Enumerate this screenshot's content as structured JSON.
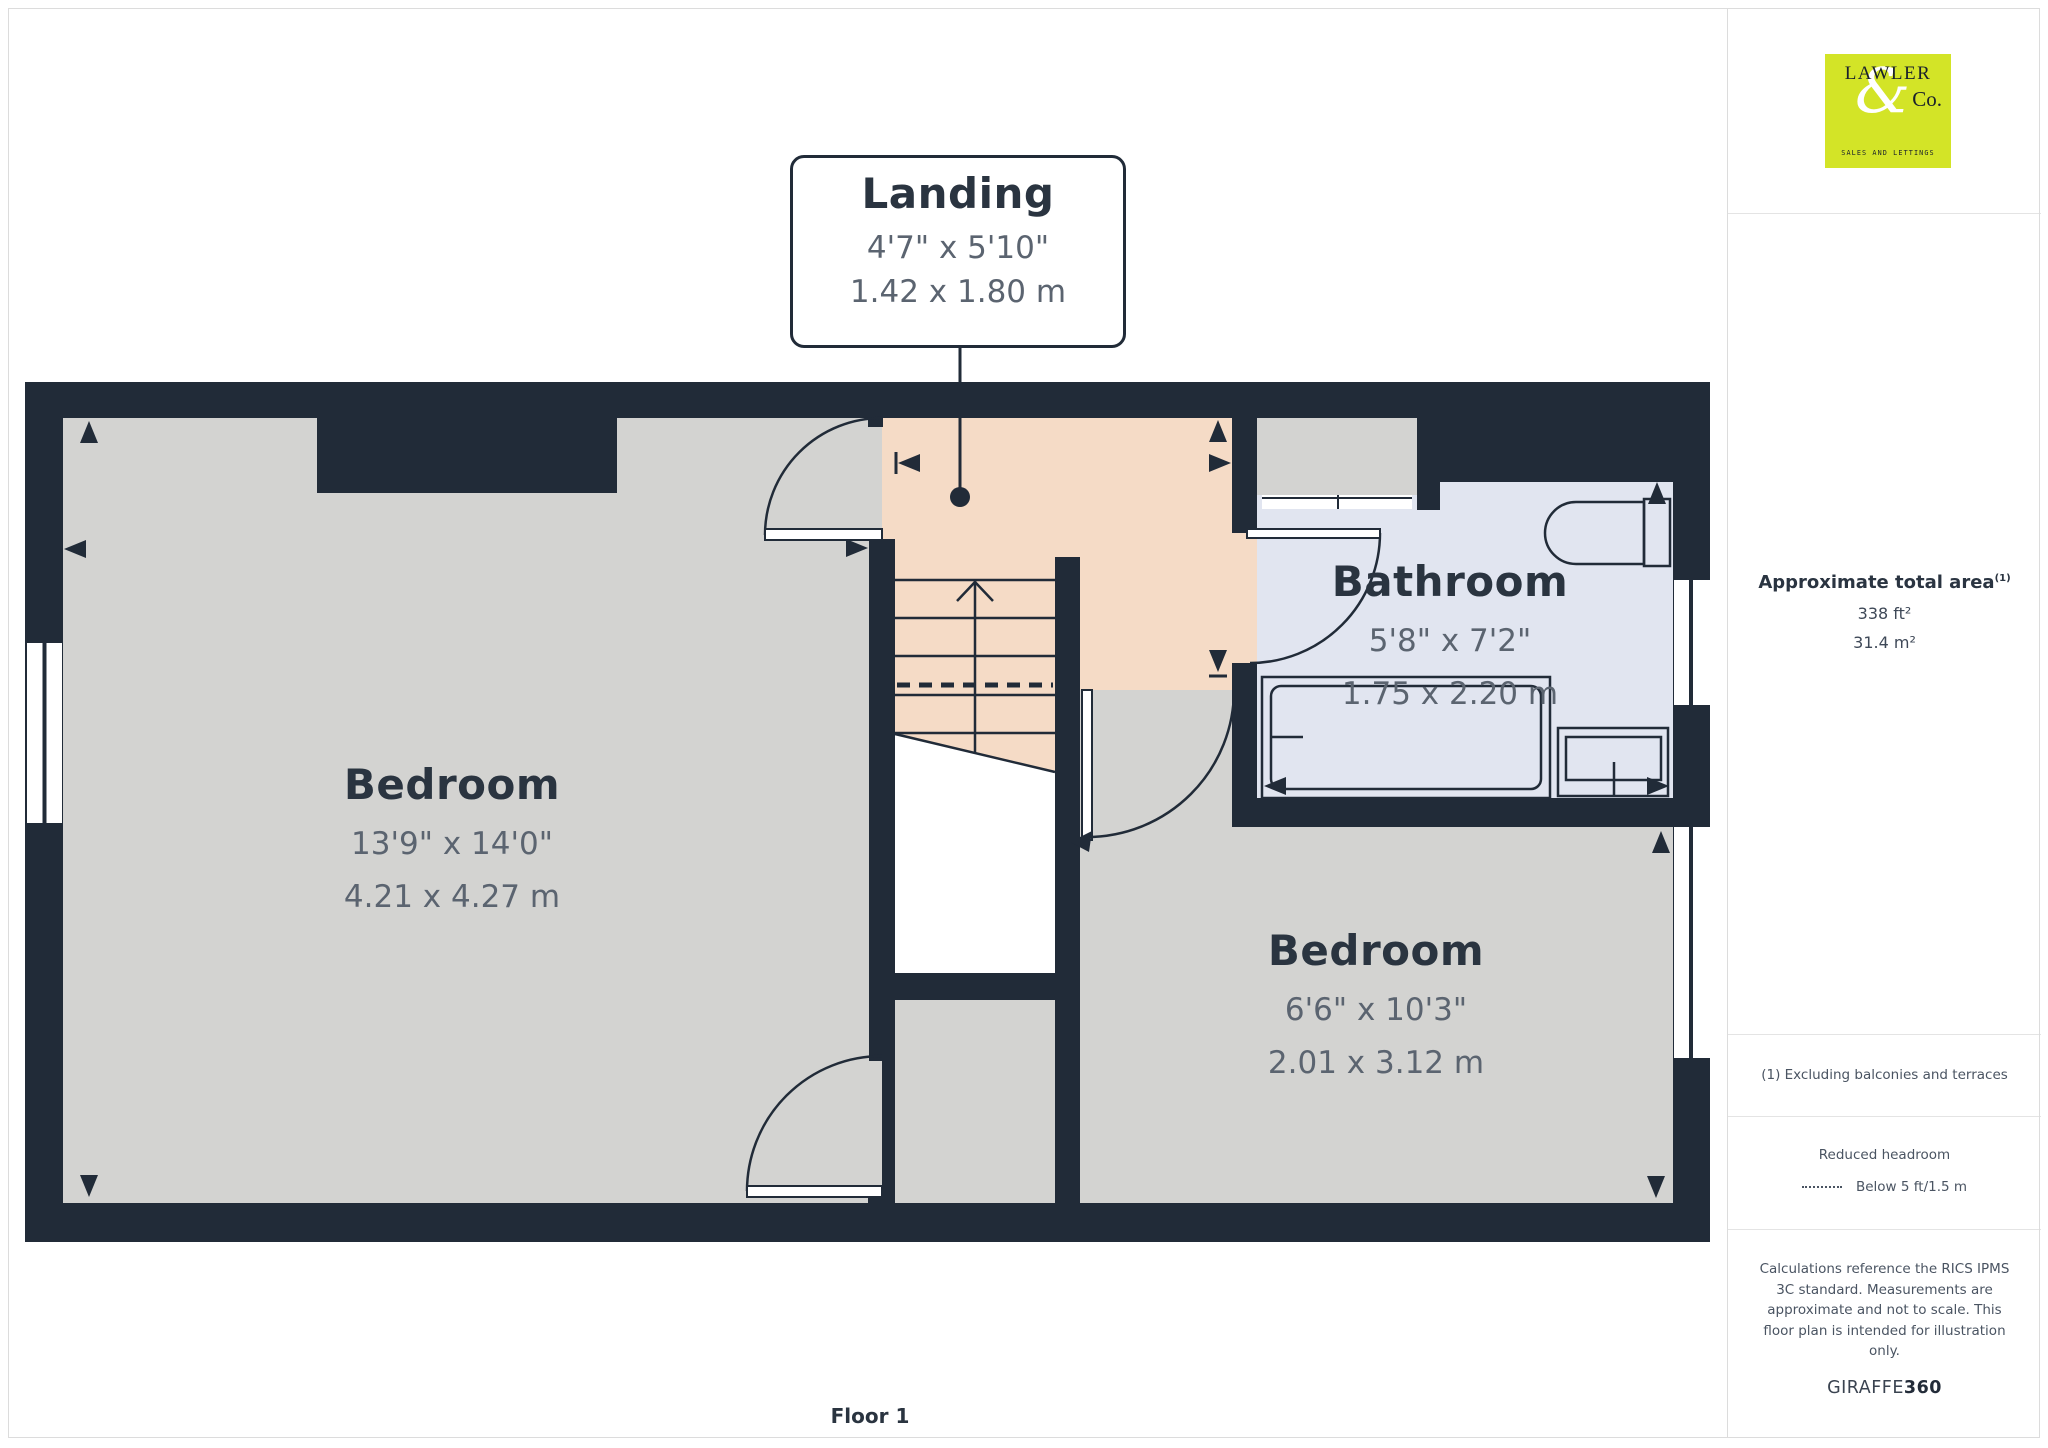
{
  "branding": {
    "logo": {
      "line1": "LAWLER",
      "amp": "&",
      "line2": "Co.",
      "tagline": "SALES AND LETTINGS"
    }
  },
  "sidebar": {
    "area": {
      "title": "Approximate total area",
      "superscript": "(1)",
      "value_imperial": "338 ft²",
      "value_metric": "31.4 m²"
    },
    "note_excluding": "(1) Excluding balconies and terraces",
    "reduced_headroom": {
      "title": "Reduced headroom",
      "legend": "Below 5 ft/1.5 m"
    },
    "disclaimer": "Calculations reference the RICS IPMS 3C standard. Measurements are approximate and not to scale. This floor plan is intended for illustration only.",
    "credit": {
      "brand": "GIRAFFE",
      "suffix": "360"
    }
  },
  "plan": {
    "floor_label": "Floor 1",
    "rooms": {
      "landing": {
        "name": "Landing",
        "imperial": "4'7\" x 5'10\"",
        "metric": "1.42 x 1.80 m"
      },
      "bedroom1": {
        "name": "Bedroom",
        "imperial": "13'9\" x 14'0\"",
        "metric": "4.21 x 4.27 m"
      },
      "bedroom2": {
        "name": "Bedroom",
        "imperial": "6'6\" x 10'3\"",
        "metric": "2.01 x 3.12 m"
      },
      "bathroom": {
        "name": "Bathroom",
        "imperial": "5'8\" x 7'2\"",
        "metric": "1.75 x 2.20 m"
      }
    }
  },
  "colors": {
    "wall": "#212b38",
    "bedroom_floor": "#d3d3d1",
    "landing_floor": "#f5dbc6",
    "bathroom_floor": "#e1e5f0",
    "label_navy": "#2a3440",
    "dim_gray": "#5b6470",
    "logo_lime": "#d3e427",
    "sidebar_text": "#4a5462",
    "border_gray": "#dcdcdc"
  }
}
